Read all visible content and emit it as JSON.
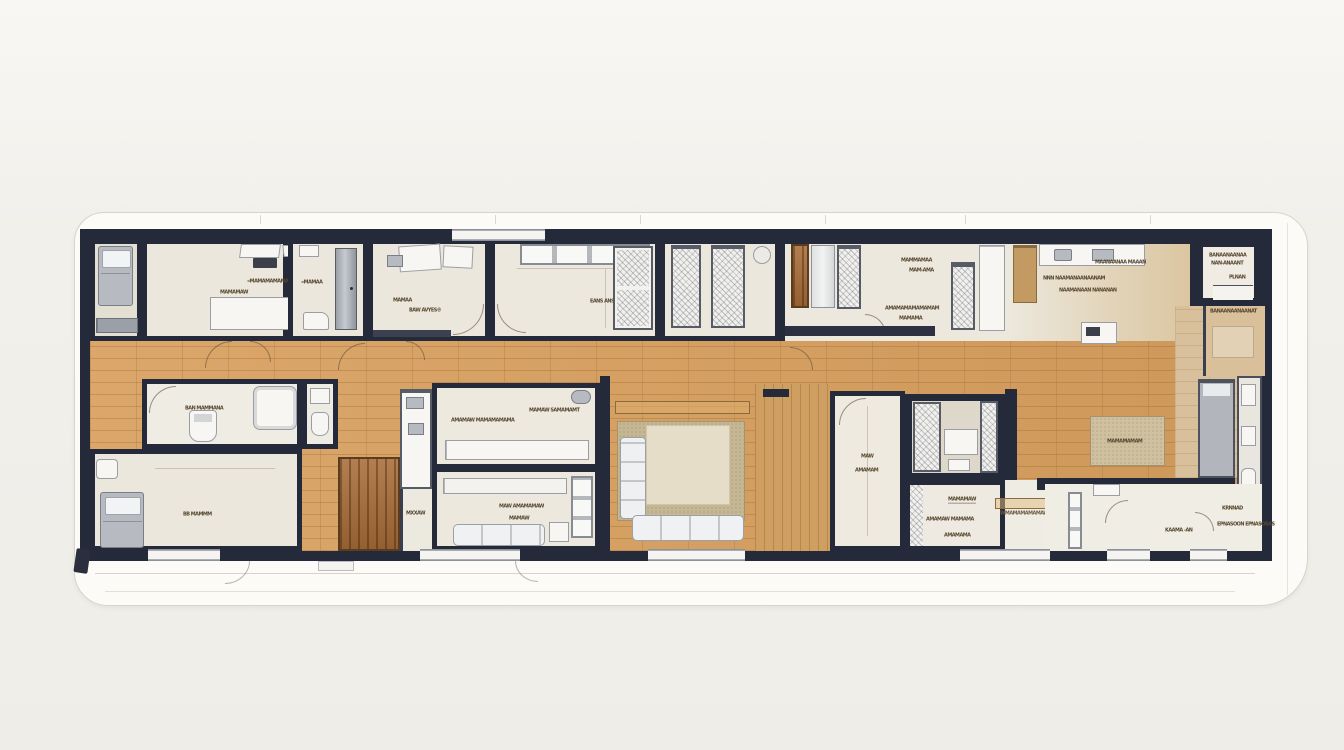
{
  "colors": {
    "wall": "#252a3a",
    "wood_floor": "#d9a05f",
    "wood_light": "#d9c09c",
    "wood_accent": "#a86d38",
    "room_floor": "#ebe7dc",
    "rug_outer": "#c6b794",
    "rug_inner": "#e5ddc8",
    "furniture_gray": "#b7bbc1",
    "card_bg": "#fcfbf8"
  },
  "labels": {
    "office_a": "«MAMAMAMAMA",
    "office_b": "MAMA",
    "office_c": "MAMAMAW",
    "utility": "«MAMAA",
    "study_a": "MAMAA",
    "study_b": "BAW AVYES®",
    "bed2_a": "EANS ANSINYANA",
    "bed2_b": "NVN",
    "kitchen_a": "MAMMAMAA",
    "kitchen_b": "MAM-AMA",
    "kitchen_c": "AMAMAMAMAMAMAM",
    "kitchen_d": "MAMAMA",
    "kitchen_e": "MAANAANAA MAAAN",
    "kitchen_f": "NNN NAAMANAANAANAM",
    "kitchen_g": "NAAMANAAN NANANAN",
    "corner_a": "BANAANAANAA",
    "corner_b": "NAN-ANAANT",
    "corner_c": "PLNAN",
    "pantry": "BANAANAANAANAT",
    "bath": "BAN MAMMANA",
    "bedroom_bl": "BB MAMMM",
    "shelf_strip": "MXXAW",
    "tv_a": "AMAMAW MAMAMAMAMA",
    "tv_b": "MAMAW SAMAMAMT",
    "lounge_a": "MAW AMAMAMAW",
    "lounge_b": "MAMAW",
    "hall_a": "MAW",
    "hall_b": "AMAMAM",
    "kids_a": "MAMAMAW",
    "kids_b": "AMAMAW MAMAMA",
    "kids_c": "AMAMAMA",
    "sideboard": "WMAMAMAMAMAW",
    "rug_right": "MAMAMAMAM",
    "entry_a": "KRNNAD",
    "entry_b": "KAAMA -AN",
    "entry_c": "EPNASOON EPNASOBAS"
  }
}
